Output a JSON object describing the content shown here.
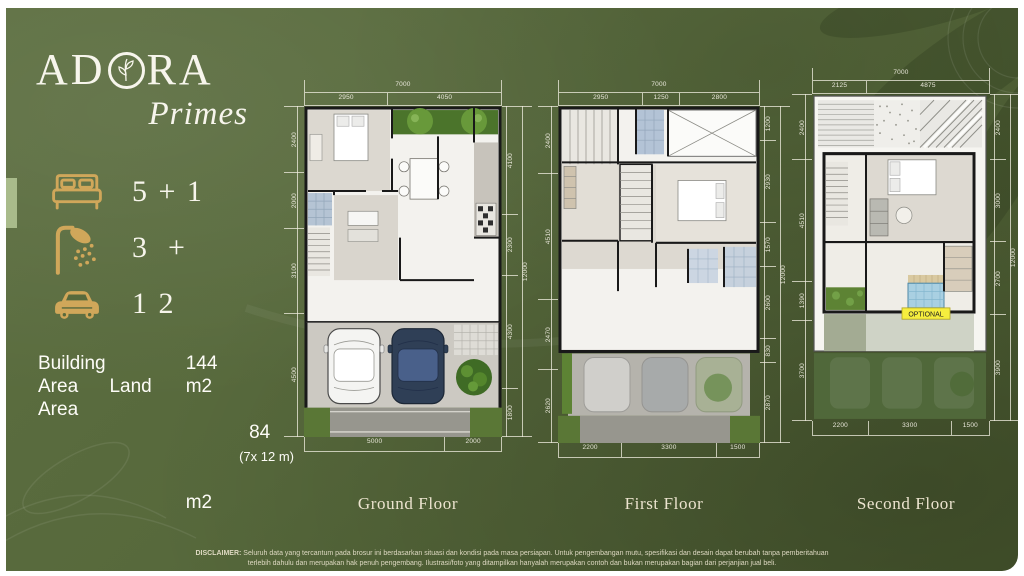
{
  "brand": {
    "name_pre": "AD",
    "name_post": "RA",
    "sub": "Primes"
  },
  "specs": [
    {
      "name": "bedrooms",
      "label": "5 + 1"
    },
    {
      "name": "bathrooms",
      "label": "3  +"
    },
    {
      "name": "carport",
      "label": "1 2"
    }
  ],
  "area_info": {
    "row1_label": "Building",
    "row1_value": "144",
    "row2_label_a": "Area",
    "row2_label_b": "Land",
    "row2_value": "m2",
    "row3_label": "Area",
    "row3_value": "84",
    "row3_dims": "(7x 12 m)",
    "row4_value": "m2"
  },
  "plans": [
    {
      "title": "Ground Floor",
      "dims": {
        "top_total": "7000",
        "top": [
          "2950",
          "4050"
        ],
        "left": [
          "2400",
          "2000",
          "3100",
          "4500"
        ],
        "right": [
          "4100",
          "2300",
          "4300",
          "1800"
        ],
        "right_total": "12000",
        "bottom": [
          "5000",
          "2000"
        ]
      }
    },
    {
      "title": "First Floor",
      "dims": {
        "top_total": "7000",
        "top": [
          "2950",
          "1250",
          "2800"
        ],
        "left": [
          "2400",
          "4510",
          "2470",
          "2620"
        ],
        "right": [
          "1200",
          "2930",
          "1570",
          "2600",
          "830",
          "2870"
        ],
        "right_total": "12000",
        "bottom": [
          "2200",
          "3300",
          "1500"
        ]
      }
    },
    {
      "title": "Second Floor",
      "optional_label": "OPTIONAL",
      "dims": {
        "top_total": "7000",
        "top": [
          "2125",
          "4875"
        ],
        "left": [
          "2400",
          "4510",
          "1390",
          "3700"
        ],
        "right": [
          "2400",
          "3000",
          "2700",
          "3900"
        ],
        "right_total": "12000",
        "bottom": [
          "2200",
          "3300",
          "1500"
        ]
      }
    }
  ],
  "disclaimer": {
    "prefix": "DISCLAIMER:",
    "line1": "Seluruh data yang tercantum pada brosur ini berdasarkan situasi dan kondisi pada masa persiapan. Untuk pengembangan mutu, spesifikasi dan desain dapat berubah tanpa pemberitahuan",
    "line2": "terlebih dahulu dan merupakan hak penuh pengembang. Ilustrasi/foto yang ditampilkan hanyalah merupakan contoh dan bukan merupakan bagian dari perjanjian jual beli."
  },
  "colors": {
    "background_green": "#57693c",
    "accent_gold": "#d0a75a",
    "text_white": "#f7f5ec",
    "title_cream": "#ece4cf",
    "optional_yellow": "#f6ee3e"
  }
}
